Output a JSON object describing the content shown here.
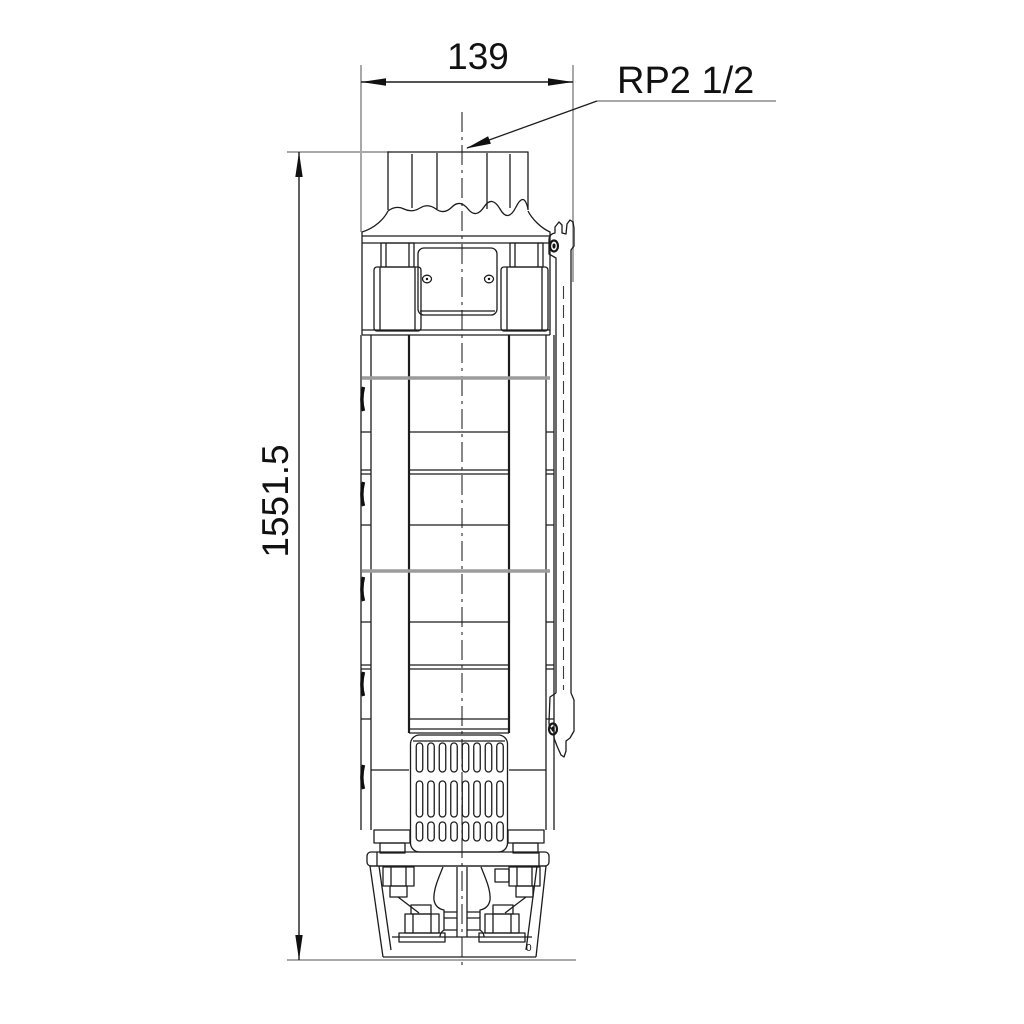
{
  "drawing": {
    "labels": {
      "width_dim": "139",
      "height_dim": "1551.5",
      "connection_port": "RP2 1/2",
      "stray_mark": "0"
    },
    "colors": {
      "background": "#ffffff",
      "outline_line": "#1c1c1c",
      "extension_line": "#a8a8a8",
      "joint_line": "#9c9c9c",
      "text": "#111111"
    }
  }
}
